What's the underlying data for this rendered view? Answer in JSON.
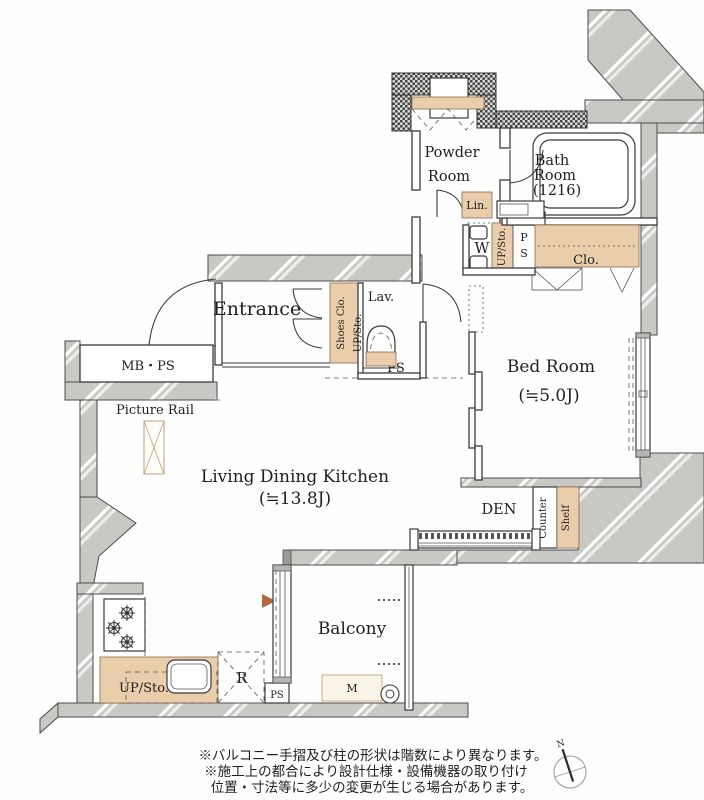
{
  "colors": {
    "wall_gray": "#c8c9c5",
    "checker_dark": "#474747",
    "storage_tan": "#eacdab",
    "line": "#3b3b3b",
    "accent_triangle": "#b2693c",
    "text": "#1f1f1f"
  },
  "rooms": {
    "powder_line1": "Powder",
    "powder_line2": "Room",
    "bath_line1": "Bath",
    "bath_line2": "Room",
    "bath_line3": "(1216)",
    "entrance": "Entrance",
    "lav": "Lav.",
    "bed_line1": "Bed Room",
    "bed_line2": "(≒5.0J)",
    "ldk_line1": "Living Dining Kitchen",
    "ldk_line2": "(≒13.8J)",
    "den": "DEN",
    "balcony": "Balcony"
  },
  "fixtures": {
    "lin": "Lin.",
    "washer": "W",
    "meter_box_balcony": "M",
    "fridge": "R",
    "clo": "Clo.",
    "shoes_clo": "Shoes Clo.",
    "up_sto_powder": "UP/Sto.",
    "up_sto_lav": "UP/Sto.",
    "up_sto_kitchen": "UP/Sto.",
    "counter": "Counter",
    "shelf": "Shelf",
    "mb_ps": "MB・PS",
    "picture_rail": "Picture Rail",
    "ps_entrance": "PS",
    "ps_kitchen": "PS",
    "ps_p": "P",
    "ps_s": "S"
  },
  "notes": {
    "line1": "※バルコニー手摺及び柱の形状は階数により異なります。",
    "line2": "※施工上の都合により設計仕様・設備機器の取り付け",
    "line3": "位置・寸法等に多少の変更が生じる場合があります。"
  },
  "compass": {
    "north": "N"
  }
}
